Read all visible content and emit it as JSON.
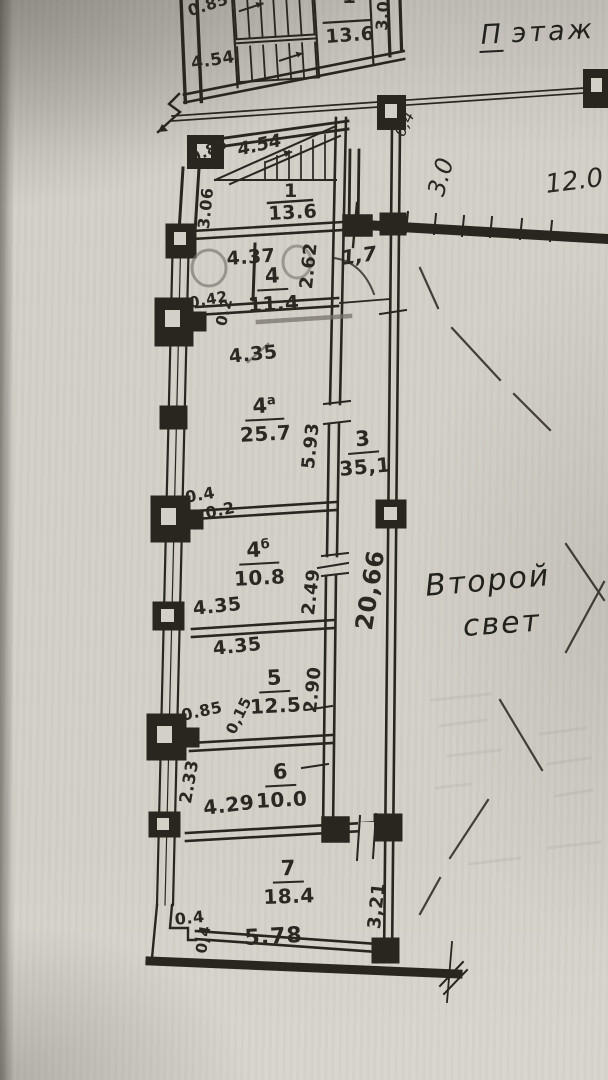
{
  "document": {
    "type": "scanned floor plan",
    "floor_title": {
      "prefix": "П",
      "word": "этаж"
    }
  },
  "open_space": {
    "note_line1": "Второй",
    "note_line2": "свет",
    "dim_width": "3.0",
    "dim_length": "12.0",
    "dim_railing": "0,4"
  },
  "upper_stairs": {
    "number": "1",
    "area": "13.6",
    "dim_side": "0.85",
    "dim_width": "4.54",
    "dim_depth": "3.0"
  },
  "stair_room": {
    "number": "1",
    "area": "13.6",
    "dim_flight": "4.54",
    "dim_wall": "0.85",
    "dim_depth": "3.06"
  },
  "room4": {
    "number": "4",
    "suffix": "",
    "area": "11.4",
    "dim_top": "4.37",
    "dim_wall_left": "0.42",
    "dim_wall_left2": "0.2",
    "dim_right": "2.62",
    "dim_corridor": "1,7",
    "dim_bottom": "4.35"
  },
  "room4a": {
    "number": "4",
    "suffix": "а",
    "area": "25.7",
    "dim_right": "5.93",
    "dim_wall_left": "0.4",
    "dim_wall_left2": "0.2"
  },
  "room3": {
    "number": "3",
    "suffix": "",
    "area": "35,1",
    "dim_length": "20,66"
  },
  "room4b": {
    "number": "4",
    "suffix": "б",
    "area": "10.8",
    "dim_right": "2.49",
    "dim_bottom": "4.35"
  },
  "room5": {
    "number": "5",
    "suffix": "",
    "area": "12.5",
    "dim_top": "4.35",
    "dim_right": "2.90",
    "dim_wall_left": "0.85",
    "dim_wall_left2": "0,15"
  },
  "room6": {
    "number": "6",
    "suffix": "",
    "area": "10.0",
    "dim_left": "2.33",
    "dim_bottom": "4.29"
  },
  "room7": {
    "number": "7",
    "suffix": "",
    "area": "18.4",
    "dim_bottom": "5.78",
    "dim_wall_left": "0.4",
    "dim_wall_left2": "0,4",
    "dim_right": "3,21"
  },
  "colors": {
    "ink": "#29261f",
    "pencil": "#77736b",
    "paper": "#d3d0c8"
  }
}
